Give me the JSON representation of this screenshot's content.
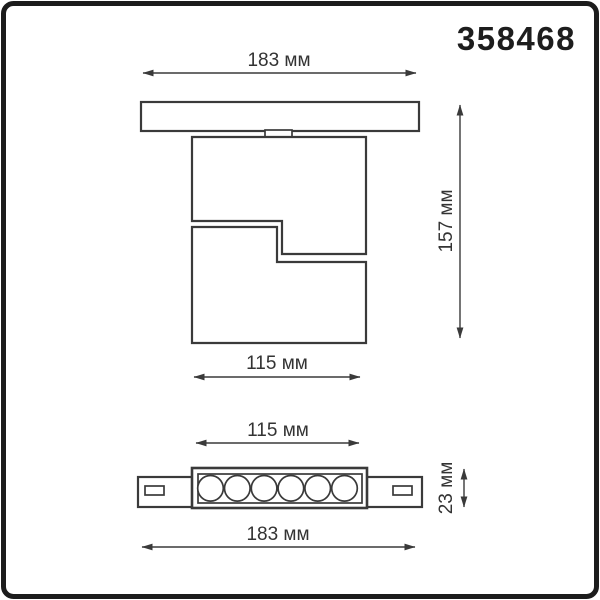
{
  "product_code": "358468",
  "views": {
    "front": {
      "title": "front view of track spotlight",
      "dimensions": {
        "track_width": "183 мм",
        "body_width": "115 мм",
        "height": "157 мм"
      }
    },
    "bottom": {
      "title": "bottom view of track spotlight",
      "led_count": 6,
      "dimensions": {
        "body_width": "115 мм",
        "total_width": "183 мм",
        "height": "23 мм"
      }
    }
  },
  "colors": {
    "background": "#ffffff",
    "frame": "#1c1c1c",
    "line": "#3a3a3a",
    "text": "#333333",
    "product_code_text": "#1d1d1d"
  }
}
